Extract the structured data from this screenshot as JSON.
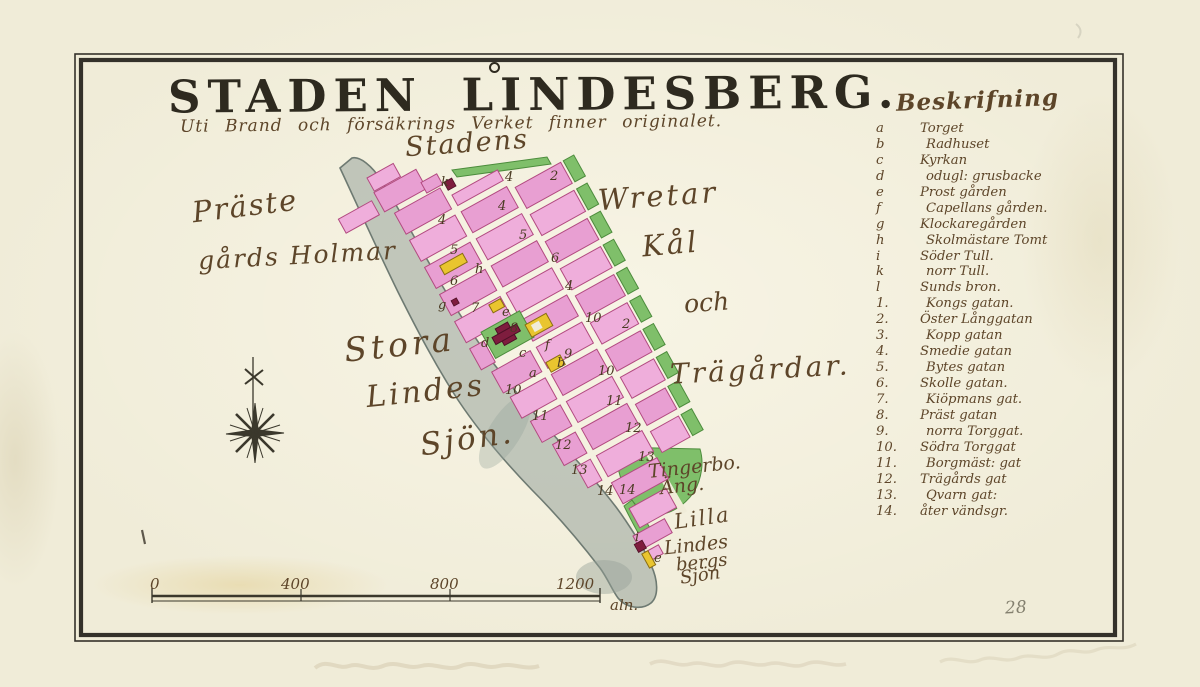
{
  "colors": {
    "paper": "#f0ecd8",
    "frame": "#34312a",
    "ink": "#2e2a1f",
    "hand": "#5d4529",
    "pink": "#e89fd2",
    "pink2": "#efaedb",
    "pinkline": "#b24a80",
    "green": "#7fbf6a",
    "greenline": "#4c8c3c",
    "yellow": "#e9c52f",
    "yellowline": "#8a6d12",
    "church": "#7e1d3e",
    "shore": "#96a29a",
    "shoreline": "#6e7a72",
    "graphite": "#84806f"
  },
  "title": "STADEN LINDESBERG.",
  "subtitle": "Uti Brand och försäkrings Verket finner originalet.",
  "page_number": "28",
  "map_labels": {
    "stadens": "Stadens",
    "praste": "Präste",
    "gards_holmar": "gårds Holmar",
    "wretar": "Wretar",
    "kal": "Kål",
    "och": "och",
    "tragardar": "Trägårdar.",
    "stora": "Stora",
    "lindes": "Lindes",
    "sjon": "Sjön.",
    "tingserbo": "Tingerbo.",
    "ang": "Äng.",
    "lilla": "Lilla",
    "lilla_lindes": "Lindes",
    "lilla_bergs": "bergs",
    "lilla_sjon": "Sjön"
  },
  "scale_bar": {
    "ticks": [
      "0",
      "400",
      "800",
      "1200"
    ],
    "unit": "aln."
  },
  "legend": {
    "heading": "Beskrifning",
    "entries": [
      {
        "key": "a",
        "label": "Torget"
      },
      {
        "key": "b",
        "label": "Radhuset"
      },
      {
        "key": "c",
        "label": "Kyrkan"
      },
      {
        "key": "d",
        "label": "odugl: grusbacke"
      },
      {
        "key": "e",
        "label": "Prost gården"
      },
      {
        "key": "f",
        "label": "Capellans gården."
      },
      {
        "key": "g",
        "label": "Klockaregården"
      },
      {
        "key": "h",
        "label": "Skolmästare Tomt"
      },
      {
        "key": "i",
        "label": "Söder Tull."
      },
      {
        "key": "k",
        "label": "norr Tull."
      },
      {
        "key": "l",
        "label": "Sunds bron."
      },
      {
        "key": "1.",
        "label": "Kongs gatan."
      },
      {
        "key": "2.",
        "label": "Öster Långgatan"
      },
      {
        "key": "3.",
        "label": "Kopp gatan"
      },
      {
        "key": "4.",
        "label": "Smedie gatan"
      },
      {
        "key": "5.",
        "label": "Bytes gatan"
      },
      {
        "key": "6.",
        "label": "Skolle gatan."
      },
      {
        "key": "7.",
        "label": "Kiöpmans gat."
      },
      {
        "key": "8.",
        "label": "Präst gatan"
      },
      {
        "key": "9.",
        "label": "norra Torggat."
      },
      {
        "key": "10.",
        "label": "Södra Torggat"
      },
      {
        "key": "11.",
        "label": "Borgmäst: gat"
      },
      {
        "key": "12.",
        "label": "Trägårds gat"
      },
      {
        "key": "13.",
        "label": "Qvarn gat:"
      },
      {
        "key": "14.",
        "label": "åter vändsgr."
      }
    ]
  },
  "block_labels": [
    {
      "t": "k"
    },
    {
      "t": "4"
    },
    {
      "t": "2"
    },
    {
      "t": "4"
    },
    {
      "t": "4"
    },
    {
      "t": "5"
    },
    {
      "t": "5"
    },
    {
      "t": "6"
    },
    {
      "t": "h"
    },
    {
      "t": "6"
    },
    {
      "t": "4"
    },
    {
      "t": "g"
    },
    {
      "t": "7"
    },
    {
      "t": "e"
    },
    {
      "t": "8"
    },
    {
      "t": "d"
    },
    {
      "t": "10"
    },
    {
      "t": "2"
    },
    {
      "t": "f"
    },
    {
      "t": "9"
    },
    {
      "t": "b"
    },
    {
      "t": "c"
    },
    {
      "t": "a"
    },
    {
      "t": "10"
    },
    {
      "t": "10"
    },
    {
      "t": "11"
    },
    {
      "t": "11"
    },
    {
      "t": "12"
    },
    {
      "t": "12"
    },
    {
      "t": "13"
    },
    {
      "t": "13"
    },
    {
      "t": "14"
    },
    {
      "t": "14"
    },
    {
      "t": "i"
    },
    {
      "t": "e"
    }
  ]
}
